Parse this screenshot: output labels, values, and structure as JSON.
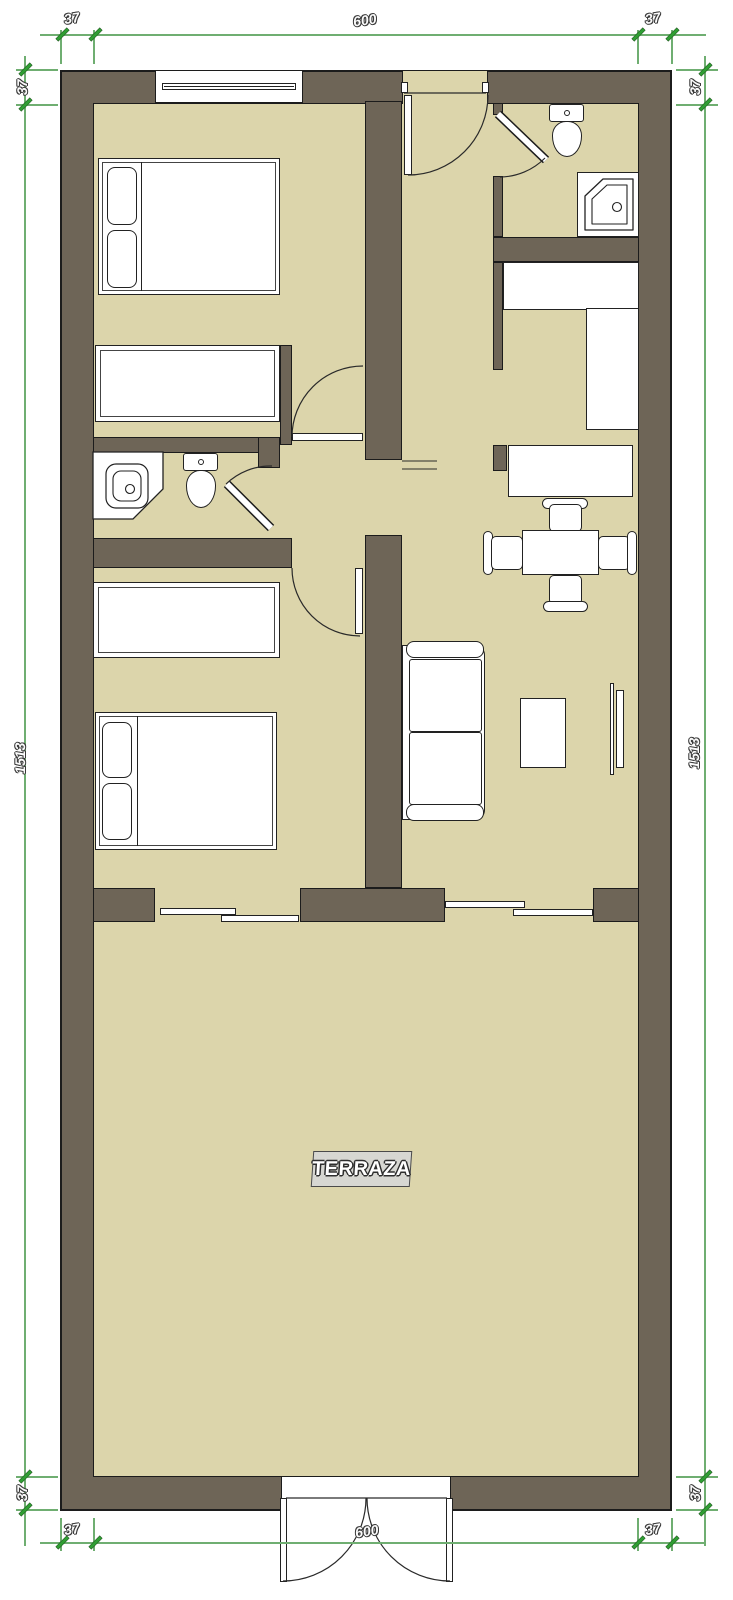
{
  "plan": {
    "title": "apartment floor plan with terrace",
    "room_labels": {
      "terraza": "TERRAZA"
    },
    "dimensions": {
      "top": {
        "left": "37",
        "center": "600",
        "right": "37"
      },
      "bottom": {
        "left": "37",
        "center": "600",
        "right": "37"
      },
      "left": {
        "top": "37",
        "middle": "1513",
        "bottom": "37"
      },
      "right": {
        "top": "37",
        "middle": "1513",
        "bottom": "37"
      }
    },
    "colors": {
      "wall_fill": "#6e6557",
      "floor_fill": "#dcd5ab",
      "outline": "#1c1c1c",
      "dimension_line": "#6fae71",
      "dimension_tick": "#2f9e33",
      "furniture_fill": "#ffffff",
      "label_box_bg": "#d7d7d2",
      "background": "#ffffff"
    },
    "furniture_icons": [
      "double-bed-icon",
      "single-bed-icon",
      "pillow-icon",
      "toilet-icon",
      "corner-sink-icon",
      "corner-shower-icon",
      "kitchen-counter-icon",
      "desk-icon",
      "dining-table-icon",
      "chair-icon",
      "sofa-icon",
      "coffee-table-icon",
      "tv-icon",
      "window-icon",
      "door-swing-icon",
      "sliding-door-icon",
      "french-door-icon"
    ]
  }
}
